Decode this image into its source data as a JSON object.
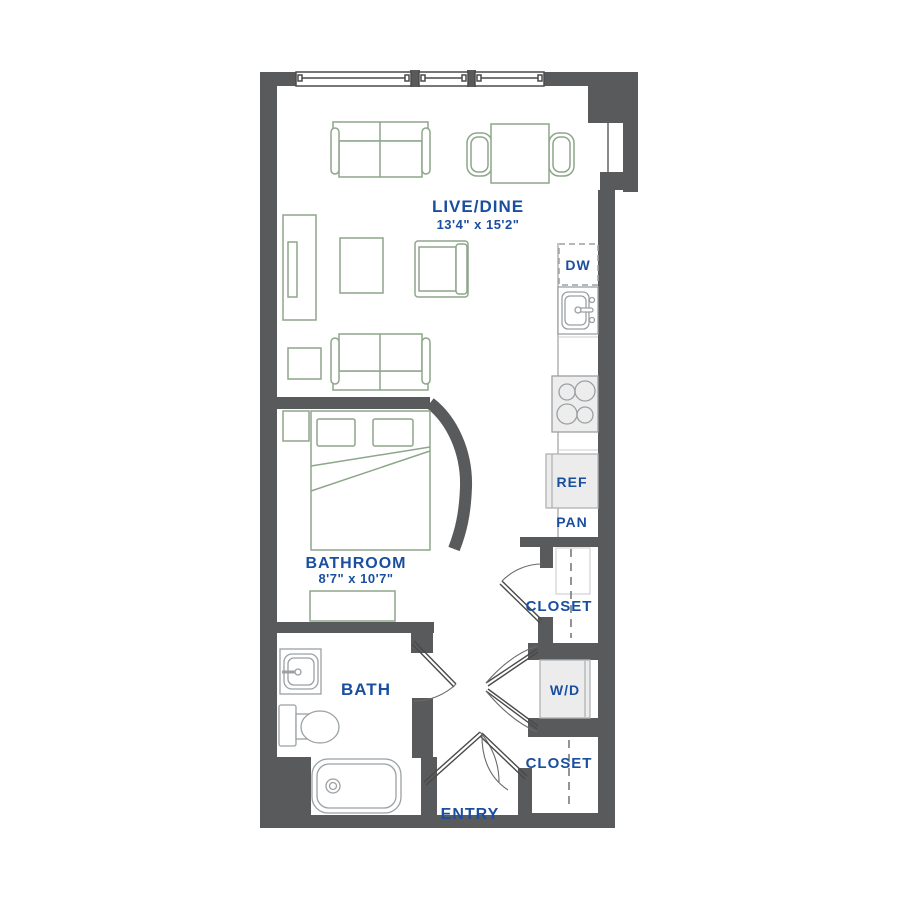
{
  "floor_plan": {
    "rooms": {
      "live_dine": {
        "label": "LIVE/DINE",
        "dimensions": "13'4\" x 15'2\""
      },
      "bathroom": {
        "label": "BATHROOM",
        "dimensions": "8'7\" x 10'7\""
      },
      "bath": {
        "label": "BATH"
      },
      "entry": {
        "label": "ENTRY"
      },
      "closet_upper": {
        "label": "CLOSET"
      },
      "closet_lower": {
        "label": "CLOSET"
      }
    },
    "appliances": {
      "dishwasher": {
        "label": "DW"
      },
      "refrigerator": {
        "label": "REF"
      },
      "pantry": {
        "label": "PAN"
      },
      "washer_dryer": {
        "label": "W/D"
      }
    },
    "colors": {
      "wall": "#595a5c",
      "label_blue": "#1a4e9f",
      "furniture_green": "#8ea68b",
      "fixture_gray": "#9aa0a3",
      "appliance_fill": "#ececec"
    }
  }
}
